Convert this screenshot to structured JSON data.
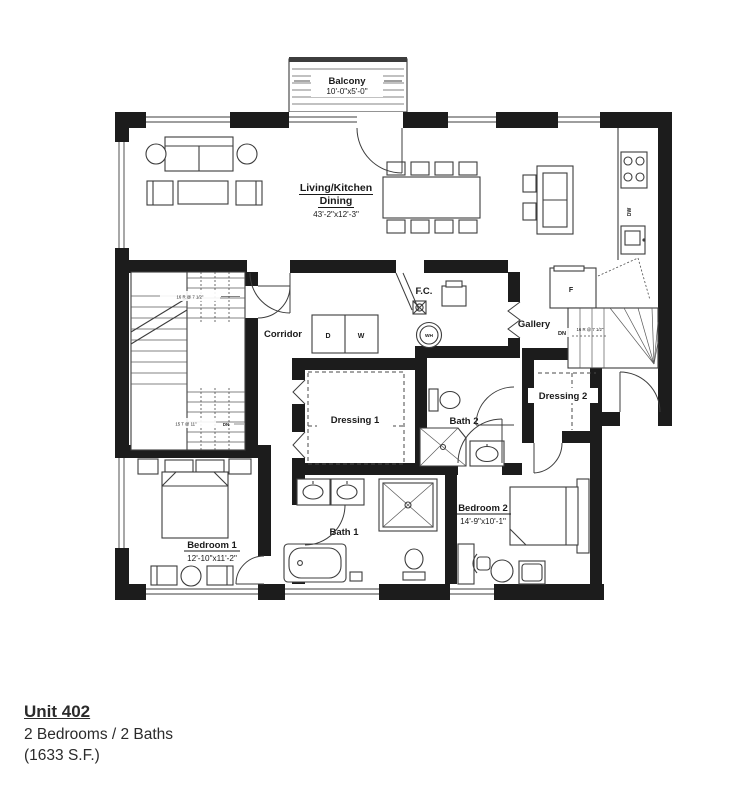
{
  "colors": {
    "wall": "#1c1c1c",
    "line": "#3d3d3d",
    "paper": "#ffffff"
  },
  "title_block": {
    "unit": "Unit 402",
    "config": "2 Bedrooms / 2 Baths",
    "area": "(1633 S.F.)"
  },
  "rooms": {
    "balcony": {
      "name": "Balcony",
      "dims": "10'-0\"x5'-0\""
    },
    "living": {
      "line1": "Living/Kitchen",
      "line2": "Dining",
      "dims": "43'-2\"x12'-3\""
    },
    "corridor": {
      "name": "Corridor"
    },
    "gallery": {
      "name": "Gallery"
    },
    "fc": {
      "name": "F.C."
    },
    "dressing1": {
      "name": "Dressing 1"
    },
    "dressing2": {
      "name": "Dressing 2"
    },
    "bath1": {
      "name": "Bath 1"
    },
    "bath2": {
      "name": "Bath 2"
    },
    "bedroom1": {
      "name": "Bedroom 1",
      "dims": "12'-10\"x11'-2\""
    },
    "bedroom2": {
      "name": "Bedroom 2",
      "dims": "14'-9\"x10'-1\""
    }
  },
  "labels": {
    "washer": "W",
    "dryer": "D",
    "water_heater": "WH",
    "fridge": "F",
    "dishwasher": "DW",
    "down": "DN",
    "stair_note_top": "16 R @ 7 1/2\"",
    "stair_note_bottom": "15 T @ 11\"",
    "stair_note_right": "16 R @ 7 1/2\""
  }
}
